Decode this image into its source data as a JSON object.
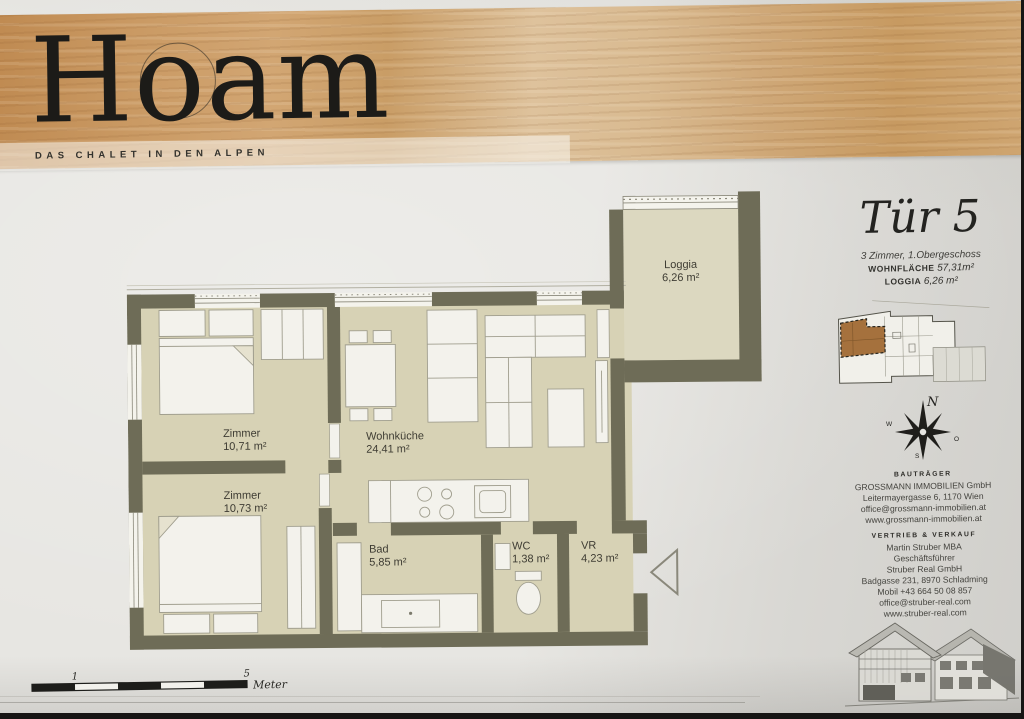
{
  "header": {
    "title": "Hoam",
    "tagline": "DAS CHALET IN DEN ALPEN"
  },
  "unit": {
    "title": "Tür 5",
    "subtitle": "3 Zimmer, 1.Obergeschoss",
    "area_label": "WOHNFLÄCHE",
    "area_value": "57,31m²",
    "loggia_label": "LOGGIA",
    "loggia_value": "6,26 m²"
  },
  "rooms": [
    {
      "name": "Zimmer",
      "area": "10,71 m²"
    },
    {
      "name": "Wohnküche",
      "area": "24,41 m²"
    },
    {
      "name": "Zimmer",
      "area": "10,73 m²"
    },
    {
      "name": "Bad",
      "area": "5,85 m²"
    },
    {
      "name": "WC",
      "area": "1,38 m²"
    },
    {
      "name": "VR",
      "area": "4,23 m²"
    },
    {
      "name": "Loggia",
      "area": "6,26 m²"
    }
  ],
  "compass": {
    "n": "N",
    "w": "W",
    "o": "O",
    "s": "S"
  },
  "contact": {
    "developer_heading": "BAUTRÄGER",
    "developer_lines": [
      "GROSSMANN IMMOBILIEN GmbH",
      "Leitermayergasse 6, 1170 Wien",
      "office@grossmann-immobilien.at",
      "www.grossmann-immobilien.at"
    ],
    "sales_heading": "VERTRIEB & VERKAUF",
    "sales_lines": [
      "Martin Struber MBA",
      "Geschäftsführer",
      "Struber Real GmbH",
      "Badgasse 231, 8970 Schladming",
      "Mobil +43 664 50 08 857",
      "office@struber-real.com",
      "www.struber-real.com"
    ]
  },
  "scalebar": {
    "tick_1": "1",
    "tick_5": "5",
    "unit": "Meter"
  },
  "colors": {
    "wall": "#6e6c57",
    "floor": "#d7d2b5",
    "loggia_floor": "#dcd8c0",
    "wood": "#c99a63",
    "highlight_unit": "#a5713d",
    "fixture": "#f3f2ec"
  }
}
